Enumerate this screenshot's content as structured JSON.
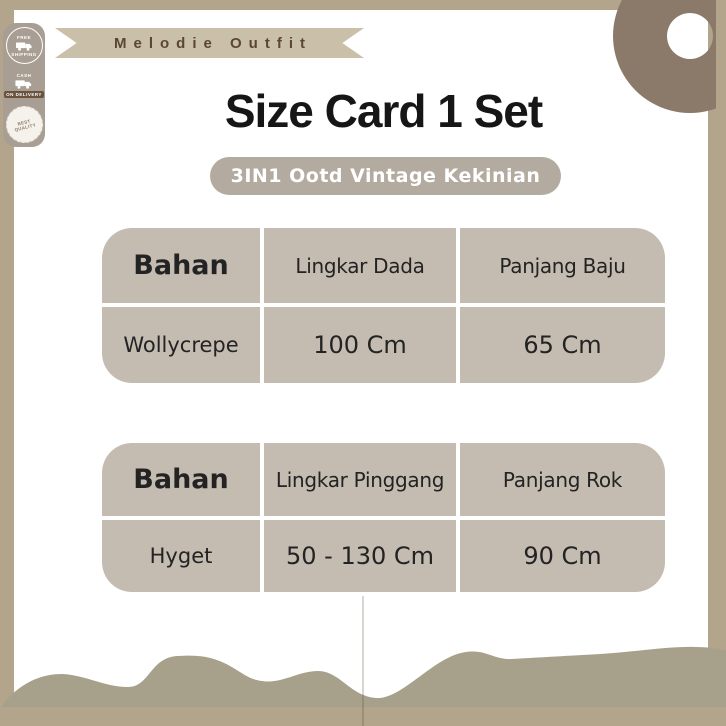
{
  "brand": {
    "ribbon_label": "Melodie Outfit"
  },
  "badges": [
    {
      "line1": "FREE",
      "line2": "SHIPPING"
    },
    {
      "line1": "CASH",
      "line2": "ON DELIVERY"
    },
    {
      "line1": "BEST",
      "line2": "QUALITY"
    }
  ],
  "header": {
    "title": "Size Card 1 Set",
    "subtitle": "3IN1 Ootd Vintage Kekinian"
  },
  "tables": [
    {
      "columns": [
        "Bahan",
        "Lingkar Dada",
        "Panjang Baju"
      ],
      "rows": [
        [
          "Wollycrepe",
          "100 Cm",
          "65 Cm"
        ]
      ]
    },
    {
      "columns": [
        "Bahan",
        "Lingkar Pinggang",
        "Panjang Rok"
      ],
      "rows": [
        [
          "Hyget",
          "50 - 130 Cm",
          "90 Cm"
        ]
      ]
    }
  ],
  "colors": {
    "frame": "#b2a58b",
    "card": "#ffffff",
    "ribbon": "#cabfa8",
    "table_bg": "#c4bbb1",
    "pill_bg": "#b4aba0",
    "badge_panel": "#a89e93",
    "ring": "#8b7a69",
    "wave": "#a7a18b",
    "title_text": "#161616",
    "ribbon_text": "#5a4732"
  }
}
